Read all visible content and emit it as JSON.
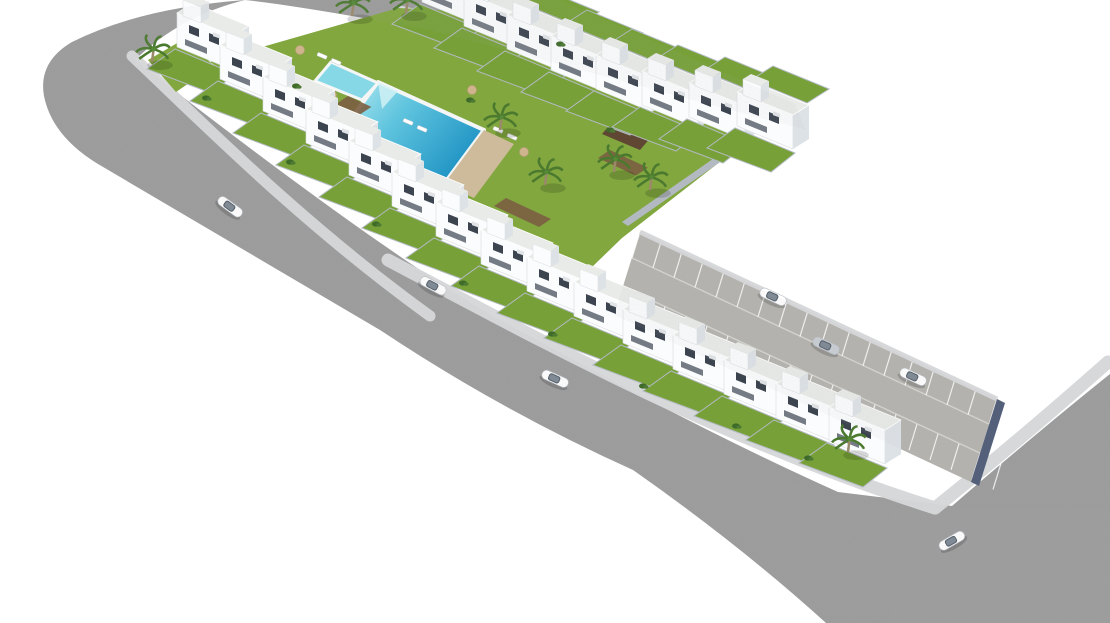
{
  "scene": {
    "title": "Aerial 3D architectural render of a residential development with communal pool, perimeter road, parking lane and cars",
    "colors": {
      "bg": "#ffffff",
      "asphalt": "#9c9c9c",
      "concrete": "#b5b3ae",
      "sidewalk": "#d7d8da",
      "gardenLawn": "#82a73f",
      "plotLawn": "#77a138",
      "houseWhite": "#fbfcfd",
      "houseShade": "#dde2e7",
      "houseRoof": "#e9ebe8",
      "window": "#3c4450",
      "wallLight": "#b2b9c0",
      "wallDark": "#54607a",
      "palm": "#4b7a2f",
      "bush": "#3f6b2a",
      "pathBrown": "#7b5f43",
      "pergola": "#5f4733",
      "deck": "#cdbb9b",
      "poolRim": "#f4f6f6",
      "poolShallow": "#b9ecf2",
      "poolDeep": "#1f93c4",
      "poolWall": "#d9cfae",
      "kidsPool": "#86d8e6",
      "carSilver": "#c9ced4"
    },
    "rows": [
      {
        "name": "north-row",
        "facing": "ne",
        "pts": [
          [
            422,
            2
          ],
          [
            464,
            26
          ],
          [
            507,
            49
          ],
          [
            551,
            70
          ],
          [
            596,
            89
          ],
          [
            642,
            105
          ],
          [
            689,
            117
          ],
          [
            737,
            126
          ]
        ]
      },
      {
        "name": "west-south-row",
        "facing": "sw",
        "pts": [
          [
            177,
            47
          ],
          [
            220,
            79
          ],
          [
            263,
            111
          ],
          [
            306,
            143
          ],
          [
            349,
            175
          ],
          [
            392,
            206
          ],
          [
            436,
            236
          ],
          [
            481,
            264
          ],
          [
            527,
            291
          ],
          [
            574,
            316
          ],
          [
            623,
            343
          ],
          [
            673,
            369
          ],
          [
            724,
            394
          ],
          [
            776,
            418
          ],
          [
            829,
            441
          ]
        ]
      }
    ],
    "parking": {
      "x0": 640,
      "y0": 232,
      "stepX": 21,
      "stepY": 9.8,
      "count": 18,
      "bayDx": -8,
      "bayDy": 26,
      "row2Dx": -17,
      "row2Dy": 55
    },
    "palms": [
      [
        152,
        62
      ],
      [
        352,
        16
      ],
      [
        406,
        13
      ],
      [
        500,
        130
      ],
      [
        545,
        185
      ],
      [
        614,
        172
      ],
      [
        650,
        190
      ],
      [
        848,
        452
      ]
    ],
    "bushes": [
      [
        206,
        98
      ],
      [
        290,
        162
      ],
      [
        376,
        224
      ],
      [
        463,
        283
      ],
      [
        552,
        334
      ],
      [
        643,
        386
      ],
      [
        736,
        426
      ],
      [
        808,
        458
      ],
      [
        470,
        100
      ],
      [
        610,
        130
      ],
      [
        296,
        86
      ],
      [
        560,
        44
      ]
    ],
    "loungers": [
      [
        322,
        56
      ],
      [
        336,
        62
      ],
      [
        408,
        122
      ],
      [
        422,
        129
      ],
      [
        498,
        130
      ],
      [
        512,
        137
      ]
    ],
    "parasols": [
      [
        300,
        50
      ],
      [
        332,
        95
      ],
      [
        472,
        90
      ],
      [
        524,
        152
      ],
      [
        436,
        198
      ],
      [
        586,
        38
      ]
    ],
    "brown_paths": [
      [
        348,
        96,
        26
      ],
      [
        506,
        198,
        50
      ],
      [
        610,
        150,
        42
      ]
    ],
    "cars": [
      {
        "x": 230,
        "y": 207,
        "angle": 36,
        "color": "#ffffff",
        "state": "driving"
      },
      {
        "x": 433,
        "y": 286,
        "angle": 28,
        "color": "#ffffff",
        "state": "driving"
      },
      {
        "x": 555,
        "y": 379,
        "angle": 24,
        "color": "#ffffff",
        "state": "driving"
      },
      {
        "x": 952,
        "y": 541,
        "angle": -30,
        "color": "#ffffff",
        "state": "driving"
      },
      {
        "x": 773,
        "y": 297,
        "angle": 25,
        "color": "#ffffff",
        "state": "parked"
      },
      {
        "x": 826,
        "y": 346,
        "angle": 25,
        "color": "#c9ced4",
        "state": "driving"
      },
      {
        "x": 913,
        "y": 377,
        "angle": 25,
        "color": "#ffffff",
        "state": "parked"
      }
    ]
  }
}
